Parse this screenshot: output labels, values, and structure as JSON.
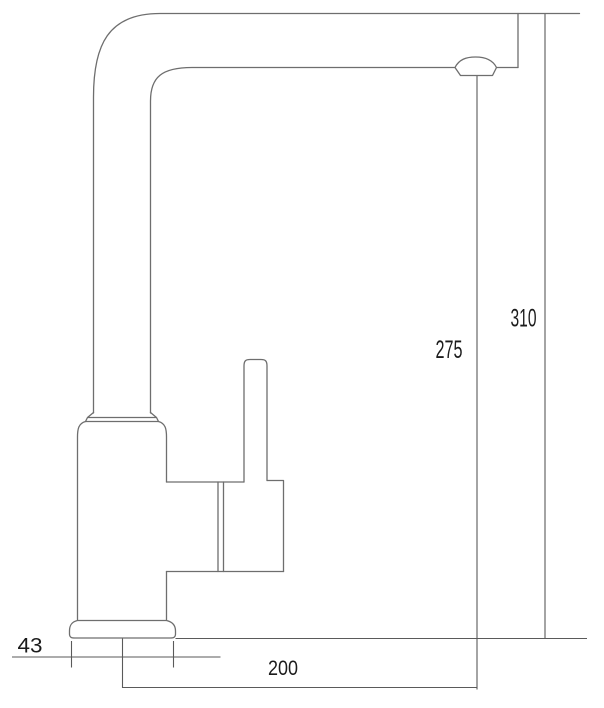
{
  "diagram": {
    "subject": "kitchen faucet technical drawing, side view",
    "dimensions": {
      "base_width": {
        "label": "43"
      },
      "spout_reach": {
        "label": "200"
      },
      "spout_height": {
        "label": "275"
      },
      "overall_height": {
        "label": "310"
      }
    },
    "colors": {
      "outline": "#6e6e6e",
      "dimension_line": "#5a5a5a",
      "label_text": "#1b1b1b",
      "background": "#ffffff"
    }
  }
}
